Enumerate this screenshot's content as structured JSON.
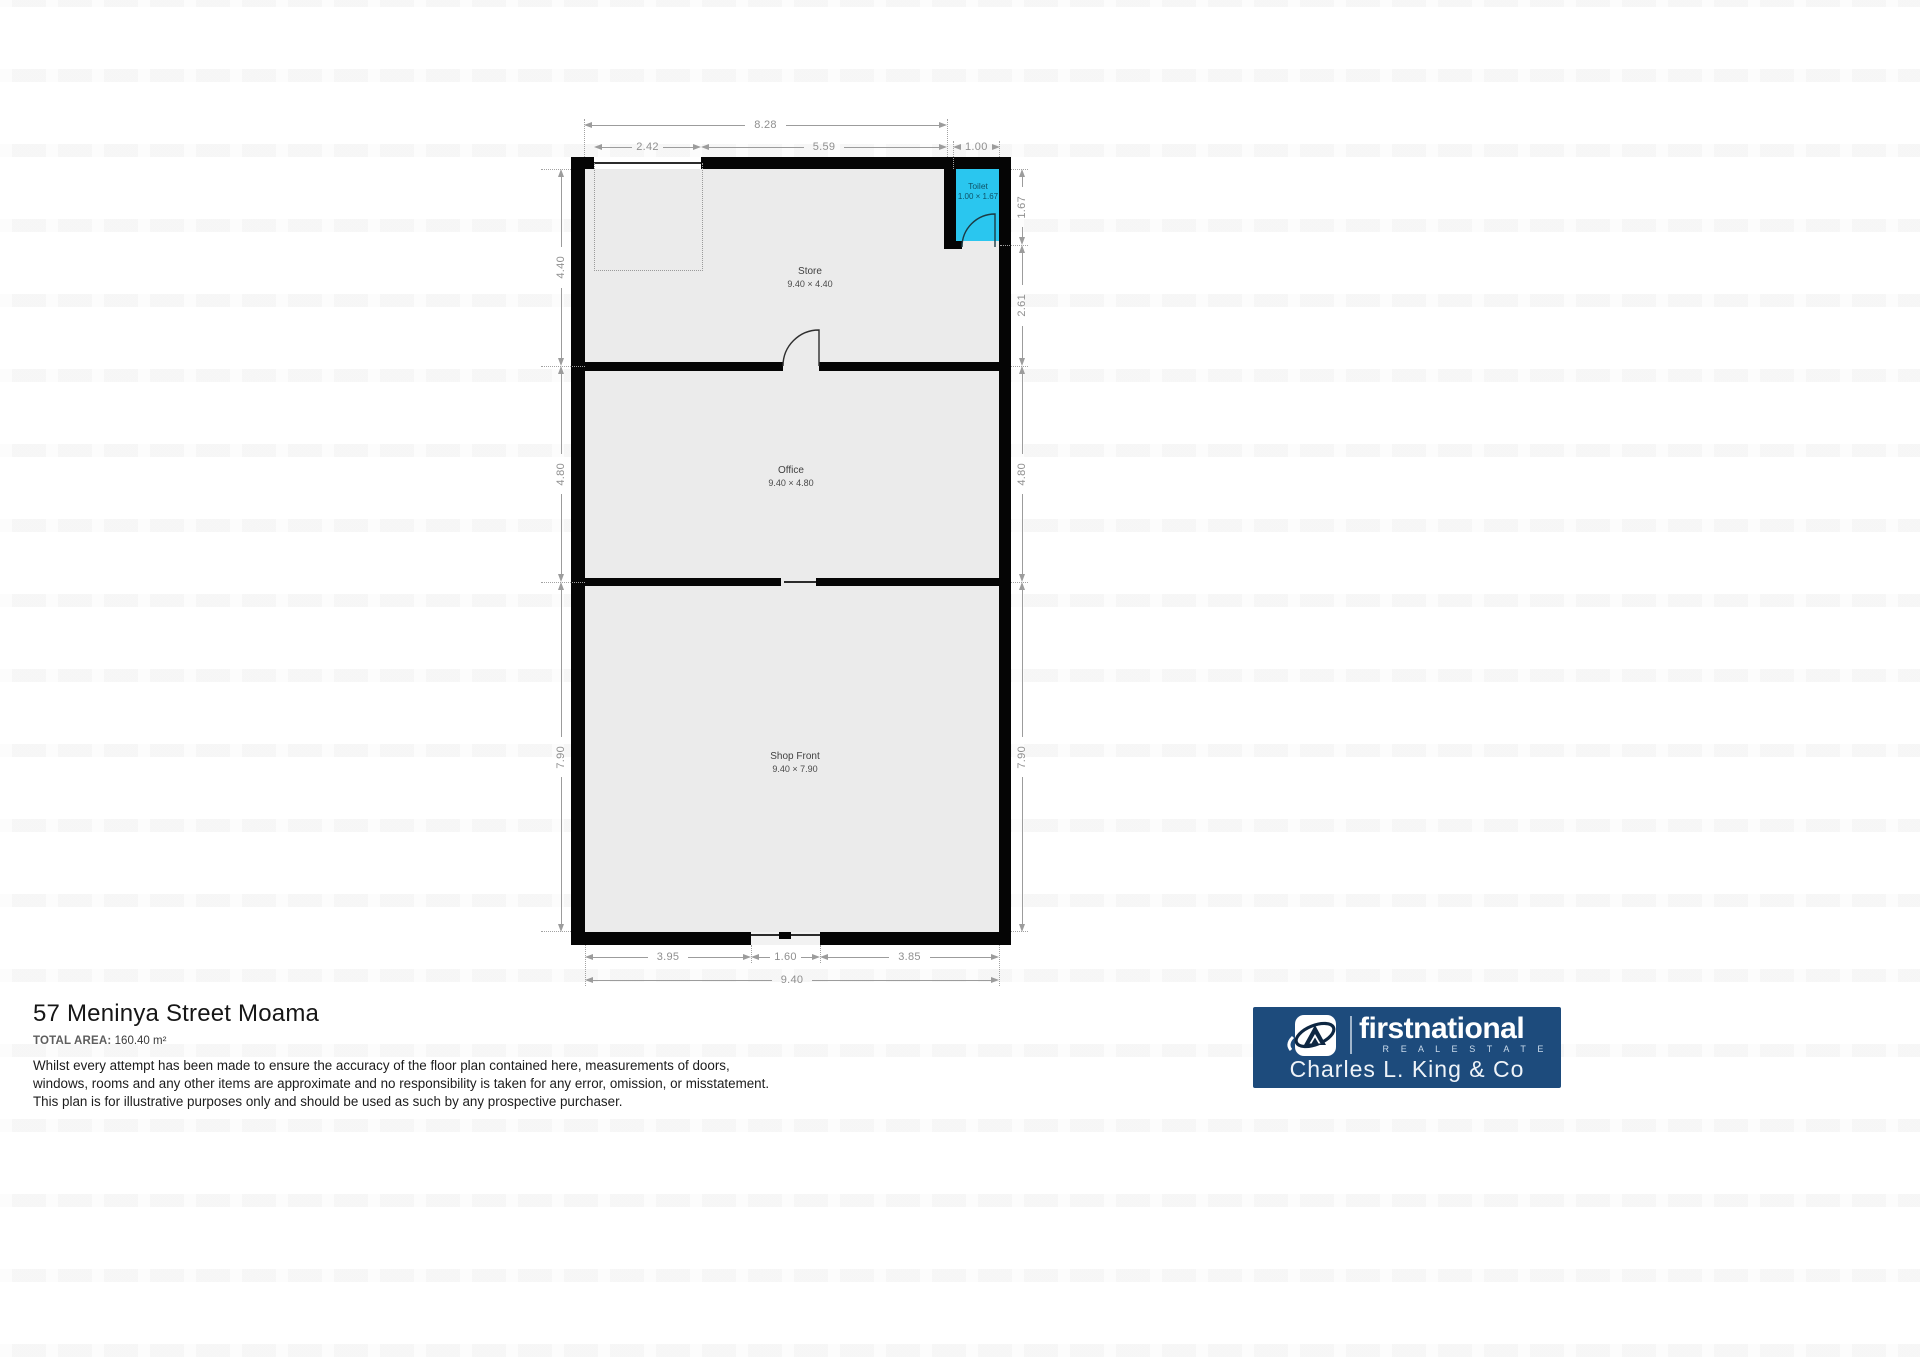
{
  "colors": {
    "wall": "#050505",
    "room_fill": "#ebebeb",
    "toilet_fill": "#2ac6ef",
    "dimension_gray": "#9c9c9c",
    "logo_navy": "#1d4b7c"
  },
  "floorplan": {
    "rooms": {
      "store": {
        "name": "Store",
        "size": "9.40 × 4.40"
      },
      "office": {
        "name": "Office",
        "size": "9.40 × 4.80"
      },
      "shop": {
        "name": "Shop Front",
        "size": "9.40 × 7.90"
      },
      "toilet": {
        "name": "Toilet",
        "size": "1.00 × 1.67"
      }
    },
    "dims": {
      "top_total": "8.28",
      "top_left": "2.42",
      "top_mid": "5.59",
      "top_toilet": "1.00",
      "bottom_left": "3.95",
      "bottom_door": "1.60",
      "bottom_right": "3.85",
      "bottom_total": "9.40",
      "left_store": "4.40",
      "left_office": "4.80",
      "left_shop": "7.90",
      "right_toilet": "1.67",
      "right_store": "2.61",
      "right_office": "4.80",
      "right_shop": "7.90"
    }
  },
  "footer": {
    "title": "57 Meninya Street Moama",
    "total_area_label": "TOTAL AREA:",
    "total_area_value": "160.40 m²",
    "disclaimer": [
      "Whilst every attempt has been made to ensure the accuracy of the floor plan contained here, measurements of doors,",
      "windows, rooms and any other items are approximate and no responsibility is taken for any error, omission, or misstatement.",
      "This plan is for illustrative purposes only and should be used as such by any prospective purchaser."
    ]
  },
  "logo": {
    "brand": "firstnational",
    "tagline": "R E A L   E S T A T E",
    "company": "Charles L. King & Co"
  }
}
